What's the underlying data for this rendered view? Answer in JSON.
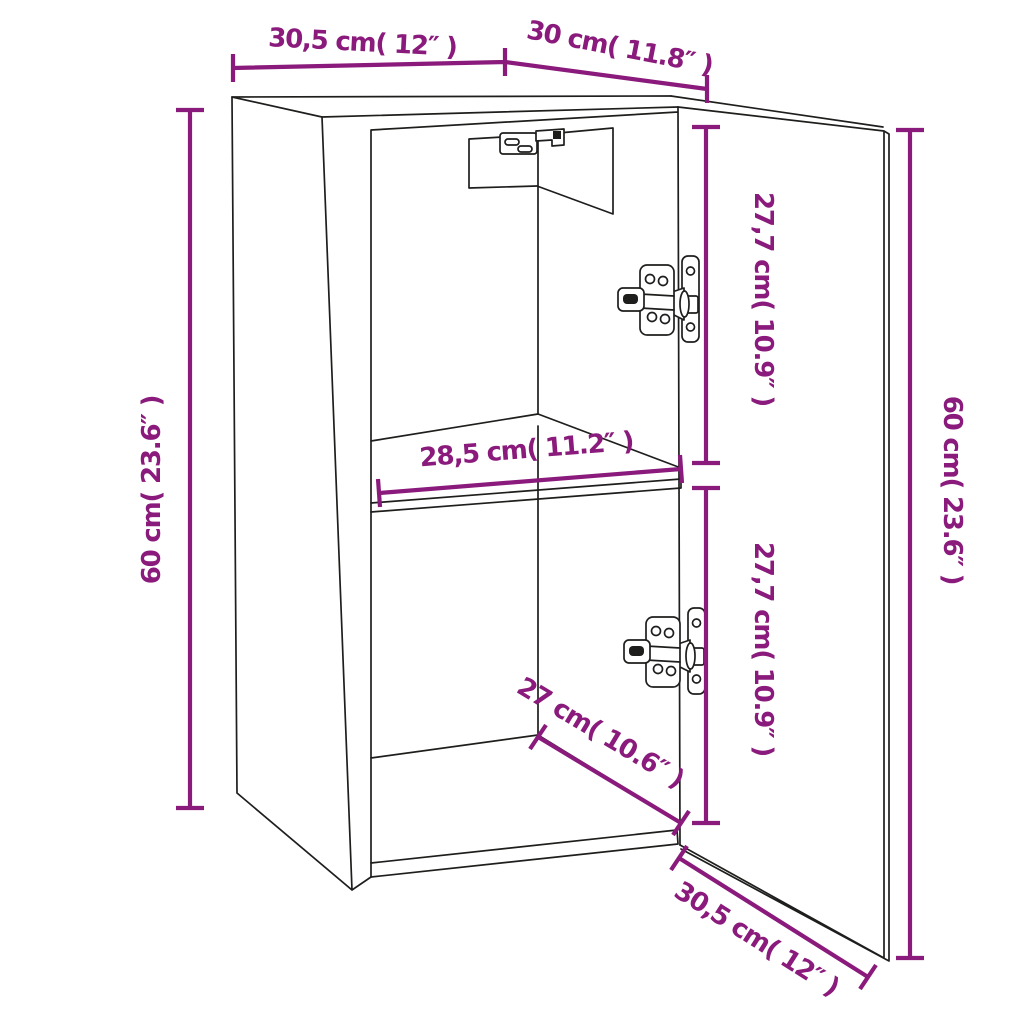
{
  "diagram": {
    "subject": "Wall-mounted cabinet line drawing with open door, wall-mount bracket, two cup hinges and a middle shelf, annotated with dimensions",
    "accent_color": "#8a1a7b",
    "line_color": "#1e1e1c",
    "background_color": "#ffffff",
    "labels": {
      "top_width": "30,5 cm( 12″ )",
      "top_depth": "30 cm( 11.8″ )",
      "left_height": "60 cm( 23.6″ )",
      "door_height": "60 cm( 23.6″ )",
      "upper_compartment_height": "27,7 cm( 10.9″ )",
      "lower_compartment_height": "27,7 cm( 10.9″ )",
      "inner_width": "28,5 cm( 11.2″ )",
      "inner_depth": "27 cm( 10.6″ )",
      "bottom_width": "30,5 cm( 12″ )"
    }
  }
}
